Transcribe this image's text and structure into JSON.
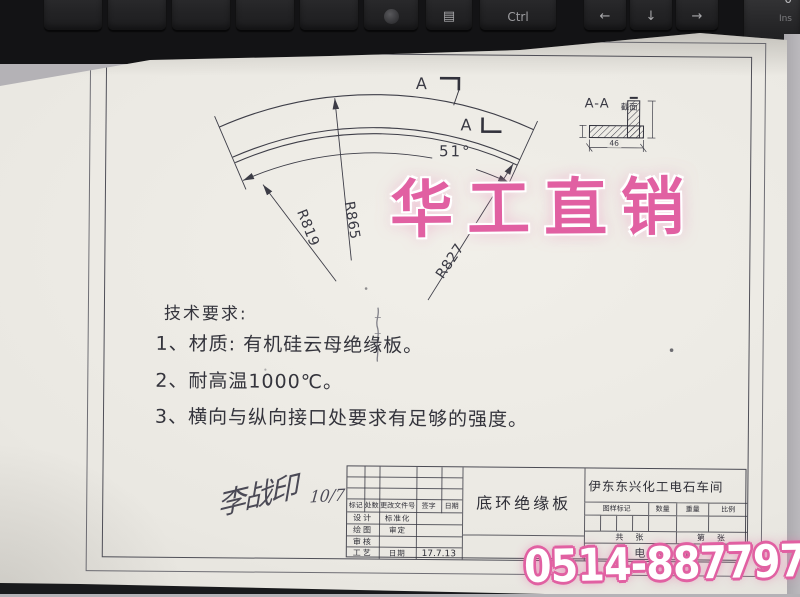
{
  "keyboard": {
    "ctrl_label": "Ctrl",
    "arrow_left": "←",
    "arrow_down": "↓",
    "arrow_right": "→",
    "zero_key_top": "0",
    "zero_key_bottom": "Ins",
    "menu_icon_glyph": "▤"
  },
  "drawing": {
    "cut_label_top": "A",
    "cut_label_bottom": "A",
    "angle": "51°",
    "radii": {
      "left": "R819",
      "middle": "R865",
      "right": "R827"
    },
    "section_view": {
      "title": "A-A",
      "subtitle": "截面",
      "width_dim": "46"
    },
    "tech": {
      "heading": "技术要求:",
      "item1": "1、材质: 有机硅云母绝缘板。",
      "item2": "2、耐高温1000℃。",
      "item3": "3、横向与纵向接口处要求有足够的强度。"
    },
    "signature": {
      "name": "李战印",
      "date": "10/7"
    }
  },
  "title_block": {
    "rev_headers": [
      "标记",
      "处数",
      "更改文件号",
      "签字",
      "日期"
    ],
    "row_labels": [
      "设计",
      "绘图",
      "审核",
      "工艺"
    ],
    "mid_labels": [
      "标准化",
      "审定",
      "",
      "日期"
    ],
    "date_value": "17.7.13",
    "part_name": "底环绝缘板",
    "company": "伊东东兴化工电石车间",
    "spec_headers": [
      "图样标记",
      "数量",
      "重量",
      "比例"
    ],
    "sheets_total": "共　张",
    "sheets_no": "第　张",
    "bottom_label": "电石炉"
  },
  "watermark": {
    "brand": "华工直销",
    "phone": "0514-88779789",
    "pink": "#e160a2"
  }
}
